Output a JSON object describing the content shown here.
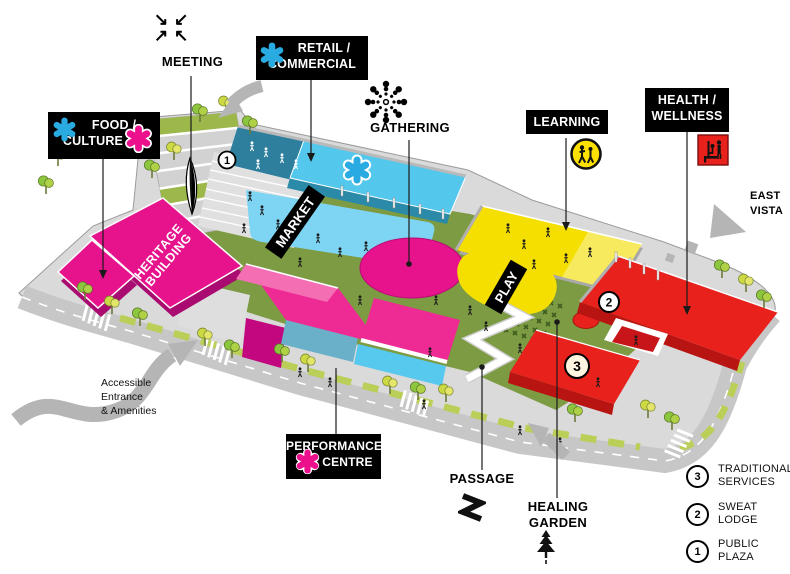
{
  "callouts": {
    "meeting": {
      "label": "MEETING"
    },
    "retail_commercial": {
      "line1": "RETAIL /",
      "line2": "COMMERCIAL"
    },
    "food_culture": {
      "line1": "FOOD /",
      "line2": "CULTURE"
    },
    "gathering": {
      "label": "GATHERING"
    },
    "learning": {
      "label": "LEARNING"
    },
    "health_wellness": {
      "line1": "HEALTH /",
      "line2": "WELLNESS"
    },
    "east_vista": {
      "line1": "EAST",
      "line2": "VISTA"
    },
    "performance_centre": {
      "line1": "PERFORMANCE",
      "line2": "CENTRE"
    },
    "passage": {
      "label": "PASSAGE"
    },
    "healing_garden": {
      "line1": "HEALING",
      "line2": "GARDEN"
    },
    "accessible_entrance": {
      "line1": "Accessible",
      "line2": "Entrance",
      "line3": "& Amenities"
    }
  },
  "plan_text": {
    "market": "MARKET",
    "play": "PLAY",
    "heritage": {
      "line1": "HERITAGE",
      "line2": "BUILDING"
    }
  },
  "plan_markers": {
    "public_plaza": "1",
    "sweat_lodge": "2",
    "traditional_services": "3"
  },
  "legend": {
    "items": [
      {
        "number": "3",
        "line1": "TRADITIONAL",
        "line2": "SERVICES"
      },
      {
        "number": "2",
        "line1": "SWEAT",
        "line2": "LODGE"
      },
      {
        "number": "1",
        "line1": "PUBLIC",
        "line2": "PLAZA"
      }
    ]
  },
  "icons": {
    "meeting_arrows": {
      "tl": "↘",
      "tr": "↙",
      "bl": "↗",
      "br": "↖"
    }
  },
  "colors": {
    "cyan": "#29abe2",
    "magenta": "#ec108c",
    "pink": "#ee2a94",
    "yellow": "#ffe000",
    "red": "#e8211d",
    "lawn_green": "#7d9b43",
    "road_gray": "#c7c7c7",
    "label_bg": "#000000",
    "label_text": "#ffffff"
  }
}
